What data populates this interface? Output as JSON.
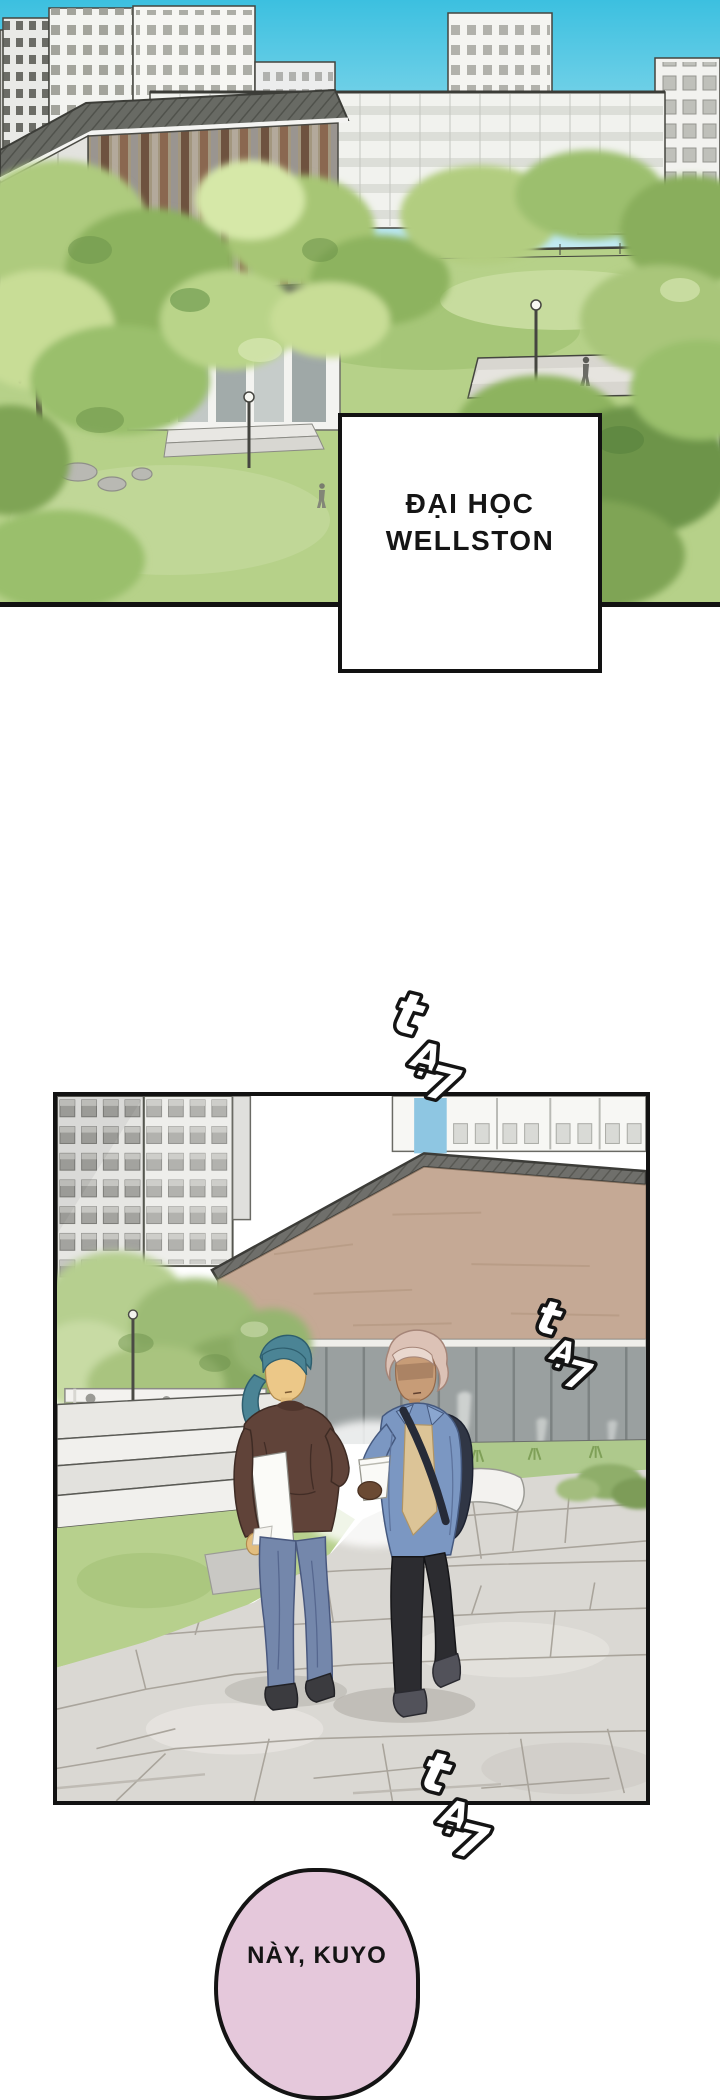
{
  "page": {
    "width": 720,
    "height": 2000,
    "background": "#ffffff"
  },
  "caption": {
    "line1": "ĐẠI HỌC",
    "line2": "WELLSTON"
  },
  "sfx": {
    "text": "tẠ7",
    "chars": [
      "t",
      "Ạ",
      "7"
    ]
  },
  "speech_bubble": {
    "text": "NÀY, KUYO",
    "fill": "#e5c8db"
  },
  "colors": {
    "panel_border": "#121212",
    "sky_top": "#3cc0e0",
    "sky_bottom": "#c9ecf4",
    "grass": "#b6d189",
    "tree_green": "#9cbb74",
    "wood_slat_brown": "#8a6750",
    "brick_wall": "#c5a995",
    "curtain_wall_gray": "#9aa0a0",
    "pavement": "#dad8d3",
    "left_hair_teal": "#4b8495",
    "left_hoodie_brown": "#604339",
    "left_jeans_blue": "#7487ab",
    "right_hair_pink": "#dcc2b6",
    "right_jacket_denim": "#7b97c2",
    "right_shirt_tan": "#dcc497",
    "right_pants_black": "#2c2c30",
    "backpack_navy": "#303645",
    "bubble_pink": "#e5c8db"
  }
}
